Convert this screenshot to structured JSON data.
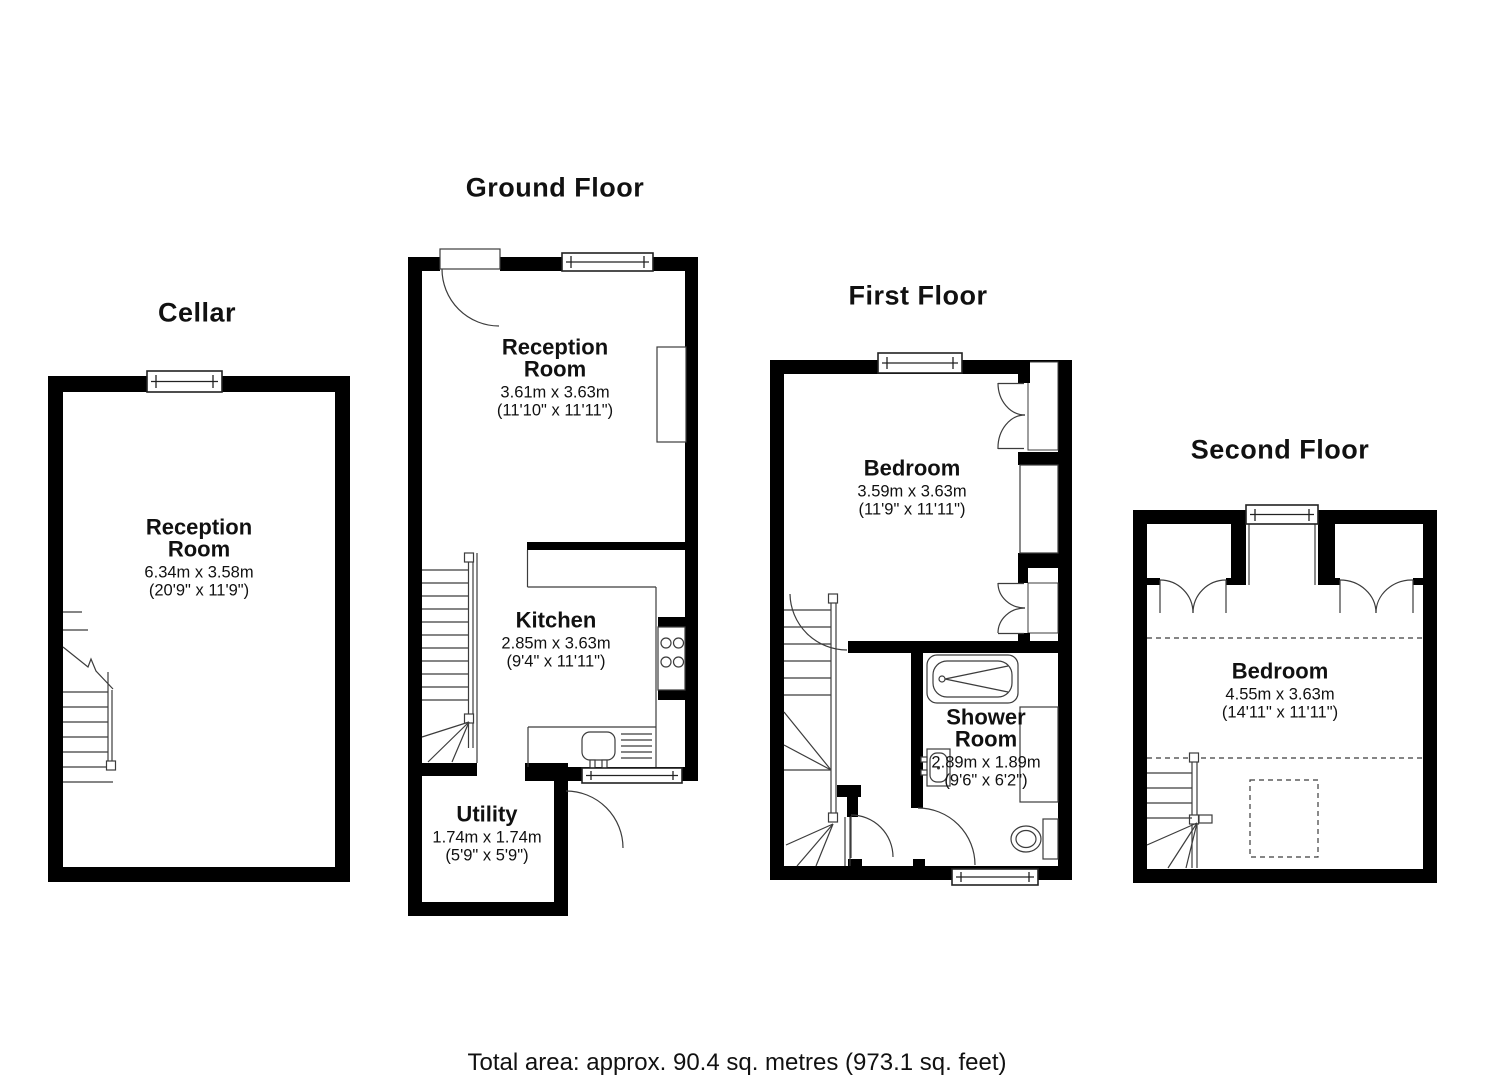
{
  "footer": {
    "total_area": "Total area: approx. 90.4 sq. metres (973.1 sq. feet)"
  },
  "floors": {
    "cellar": {
      "title": "Cellar",
      "reception": {
        "name": [
          "Reception",
          "Room"
        ],
        "metric": "6.34m x 3.58m",
        "imperial": "(20'9\" x 11'9\")"
      }
    },
    "ground": {
      "title": "Ground Floor",
      "reception": {
        "name": [
          "Reception",
          "Room"
        ],
        "metric": "3.61m x 3.63m",
        "imperial": "(11'10\" x 11'11\")"
      },
      "kitchen": {
        "name": [
          "Kitchen"
        ],
        "metric": "2.85m x 3.63m",
        "imperial": "(9'4\" x 11'11\")"
      },
      "utility": {
        "name": [
          "Utility"
        ],
        "metric": "1.74m x 1.74m",
        "imperial": "(5'9\" x 5'9\")"
      }
    },
    "first": {
      "title": "First Floor",
      "bedroom": {
        "name": [
          "Bedroom"
        ],
        "metric": "3.59m x 3.63m",
        "imperial": "(11'9\" x 11'11\")"
      },
      "shower": {
        "name": [
          "Shower",
          "Room"
        ],
        "metric": "2.89m x 1.89m",
        "imperial": "(9'6\" x 6'2\")"
      }
    },
    "second": {
      "title": "Second Floor",
      "bedroom": {
        "name": [
          "Bedroom"
        ],
        "metric": "4.55m x 3.63m",
        "imperial": "(14'11\" x 11'11\")"
      }
    }
  },
  "colors": {
    "wall": "#000000",
    "line": "#3c3c3c",
    "background": "#ffffff"
  }
}
